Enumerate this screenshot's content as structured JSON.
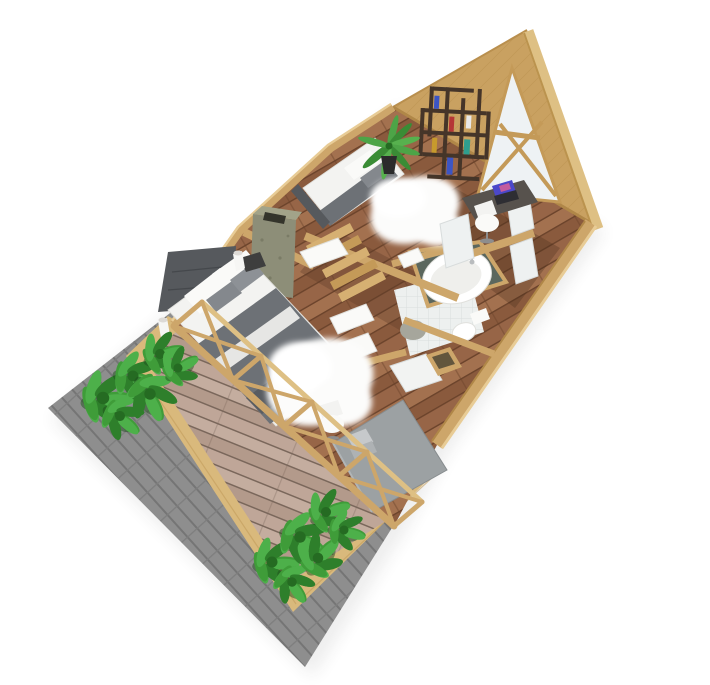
{
  "scene": {
    "type": "isometric-3d-floor-plan-render",
    "subject": "a-frame-cabin-cutaway",
    "background": "#ffffff"
  },
  "rooms": [
    "loft-bedroom",
    "study-nook",
    "bathroom",
    "hallway-stairs",
    "master-bedroom",
    "home-office",
    "deck-terrace"
  ],
  "inventory": [
    "gray-shingle-roof",
    "wood-deck-frame",
    "deck-planks",
    "planter-bushes",
    "glass-wall-x-braces",
    "a-frame-gable",
    "gable-window",
    "roof-edge-beam",
    "loft-bed",
    "bookshelf",
    "potted-palm",
    "sheepskin-rug",
    "study-desk",
    "laptop",
    "desk-chair",
    "partition-panels",
    "slate-bath-platform",
    "bathtub",
    "toilet",
    "bath-mat",
    "tile-floor",
    "staircase",
    "door-panels",
    "stone-chimney",
    "master-bed",
    "tufted-headboard",
    "pillows",
    "nightstand",
    "wall-sconces",
    "office-desk",
    "silver-laptop",
    "office-chair",
    "storage-cabinet"
  ],
  "palette": {
    "bg": "#ffffff",
    "shadow": "#2b2b2b",
    "shingle": "#8e8e8e",
    "shingle_dark": "#757575",
    "shingle_joint": "#7e7e7e",
    "deck_frame": "#d9b97c",
    "deck_frame_edge": "#c09a58",
    "deck_a": "#c4ad9f",
    "deck_b": "#b39a8b",
    "deck_c": "#bfa698",
    "deck_gap": "#7a675b",
    "floor_a": "#a3714f",
    "floor_b": "#8a5a3d",
    "floor_c": "#976547",
    "floor_gap": "#6b432b",
    "wall": "#cda66a",
    "wall_hi": "#e8cc96",
    "wall_dark": "#b08748",
    "gable": "#c9a161",
    "gable_grain": "#b98f4e",
    "beam": "#dec084",
    "beam_edge": "#bb934e",
    "glass": "#eef2f4",
    "window_frame": "#c49a58",
    "shelf": "#453529",
    "book_blue": "#3c55c4",
    "book_red": "#b53636",
    "book_teal": "#2f9e8f",
    "book_gold": "#c79a2d",
    "book_white": "#e8e8e8",
    "leaf_a": "#3f9c39",
    "leaf_b": "#2e7f2b",
    "leaf_c": "#4db04a",
    "leaf_core": "#256b22",
    "leaf_shadow": "#1e4d1c",
    "palm_a": "#4da447",
    "palm_b": "#3a8c35",
    "palm_c": "#57b14e",
    "pot": "#2b2b2b",
    "linen": "#f3f3f1",
    "linen_bright": "#fafaf8",
    "linen_edge": "#e0e0dc",
    "blanket": "#6d7176",
    "blanket_dark": "#585c61",
    "pillow_gray": "#84888d",
    "pillow_gray2": "#8d9196",
    "headboard": "#56595d",
    "headboard_line": "#45484c",
    "rug": "#fcfcfb",
    "rug_core": "#ffffff",
    "stone": "#8d8e78",
    "stone_top": "#a2a389",
    "stone_hole": "#34342b",
    "stone_speck": "#7a7b66",
    "slate": "#5b675e",
    "tile": "#edf0ef",
    "tile_line": "#d9dedd",
    "tub_inner": "#efefec",
    "chrome": "#b9bcbe",
    "mat": "#a6a69c",
    "desk_dark": "#57524d",
    "laptop_screen": "#4b48c9",
    "laptop_accent": "#c35b9e",
    "laptop_base": "#2e2e33",
    "panel": "#eef1f1",
    "panel_edge": "#d8dcdc",
    "office_desk": "#9ca1a3",
    "office_desk_edge": "#878c8e",
    "office_desk_hi": "#b0b5b7",
    "silver": "#c6c9cb",
    "silver2": "#aeb2b4",
    "silver_edge": "#9fa3a5",
    "chair_base": "#8d8d8d",
    "cabinet": "#f2f3f2",
    "hall_tint": "#5f3d28",
    "nook_tint": "#3f2817",
    "nightstand": "#3e3e3e",
    "sconce": "#f6f6f4",
    "sconce_top": "#dddad6",
    "stair_a": "#d6b072",
    "stair_b": "#c49a58"
  }
}
